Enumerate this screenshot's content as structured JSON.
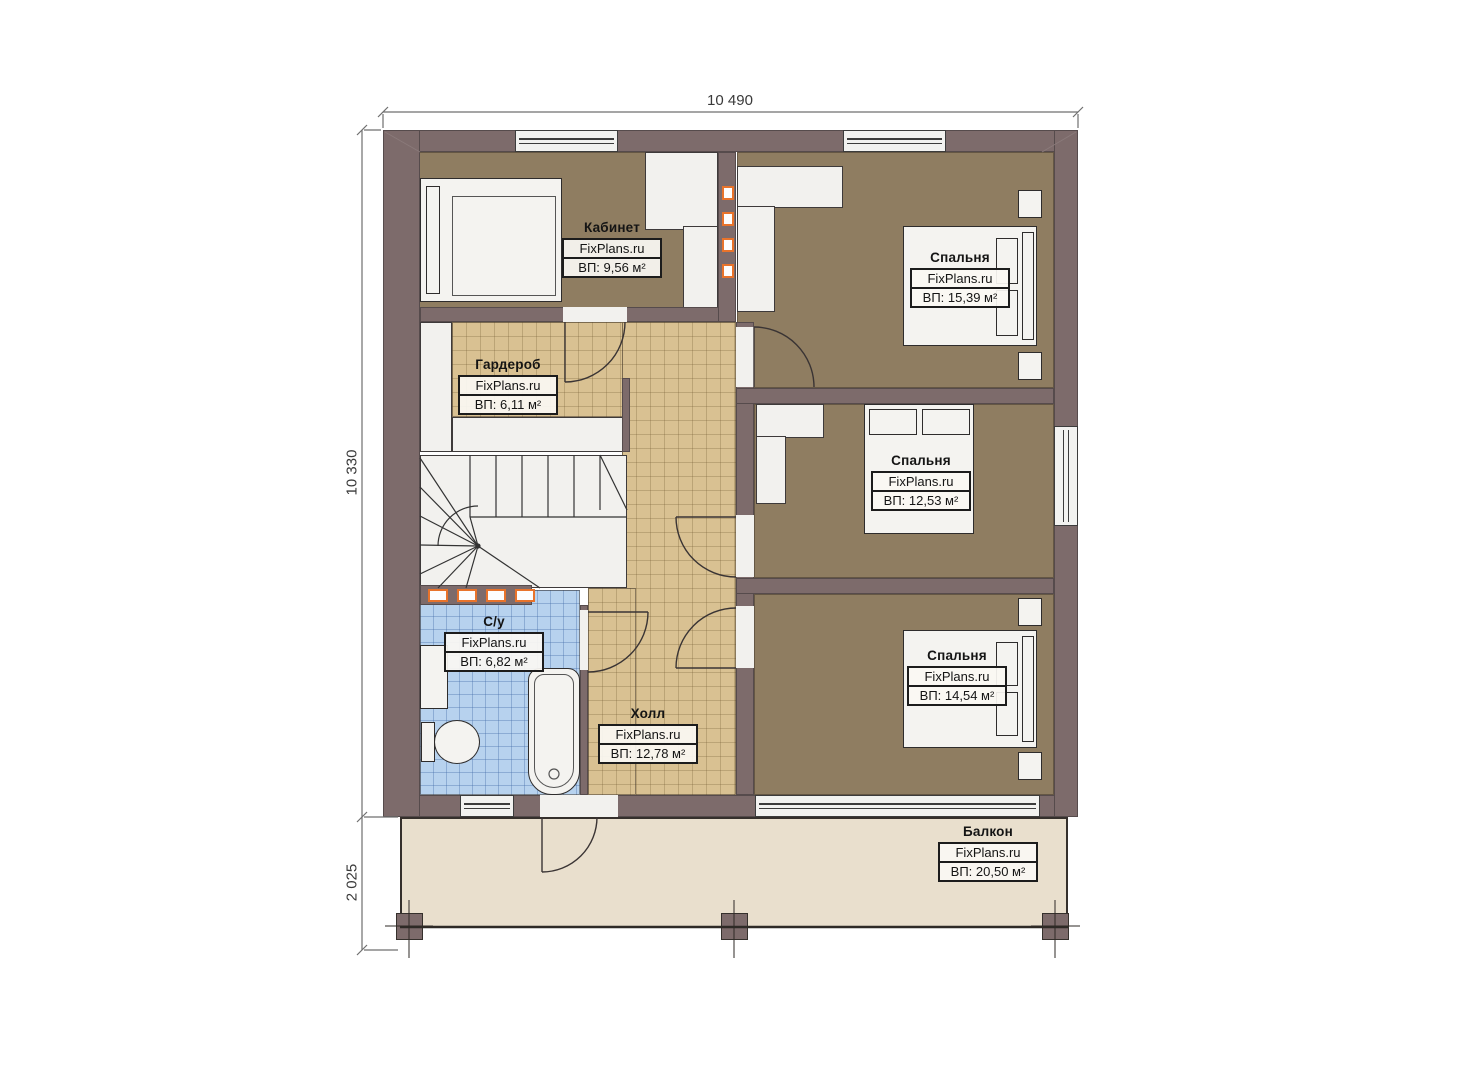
{
  "brand": "FixPlans.ru",
  "dimensions": {
    "width_top": "10 490",
    "height_main": "10 330",
    "height_balcony": "2 025"
  },
  "rooms": {
    "office": {
      "name": "Кабинет",
      "area": "ВП: 9,56 м²"
    },
    "wardrobe": {
      "name": "Гардероб",
      "area": "ВП: 6,11 м²"
    },
    "bedroom_top": {
      "name": "Спальня",
      "area": "ВП: 15,39 м²"
    },
    "bedroom_mid": {
      "name": "Спальня",
      "area": "ВП: 12,53 м²"
    },
    "bedroom_bottom": {
      "name": "Спальня",
      "area": "ВП: 14,54 м²"
    },
    "bathroom": {
      "name": "С/у",
      "area": "ВП: 6,82 м²"
    },
    "hall": {
      "name": "Холл",
      "area": "ВП: 12,78 м²"
    },
    "balcony": {
      "name": "Балкон",
      "area": "ВП: 20,50 м²"
    }
  },
  "colors": {
    "wall": "#7d6b6b",
    "room_brown": "#8f7d61",
    "tile_tan": "#d9c192",
    "tile_blue": "#b7d2ee",
    "balcony": "#e9dfcd",
    "accent_orange": "#e8732b"
  }
}
